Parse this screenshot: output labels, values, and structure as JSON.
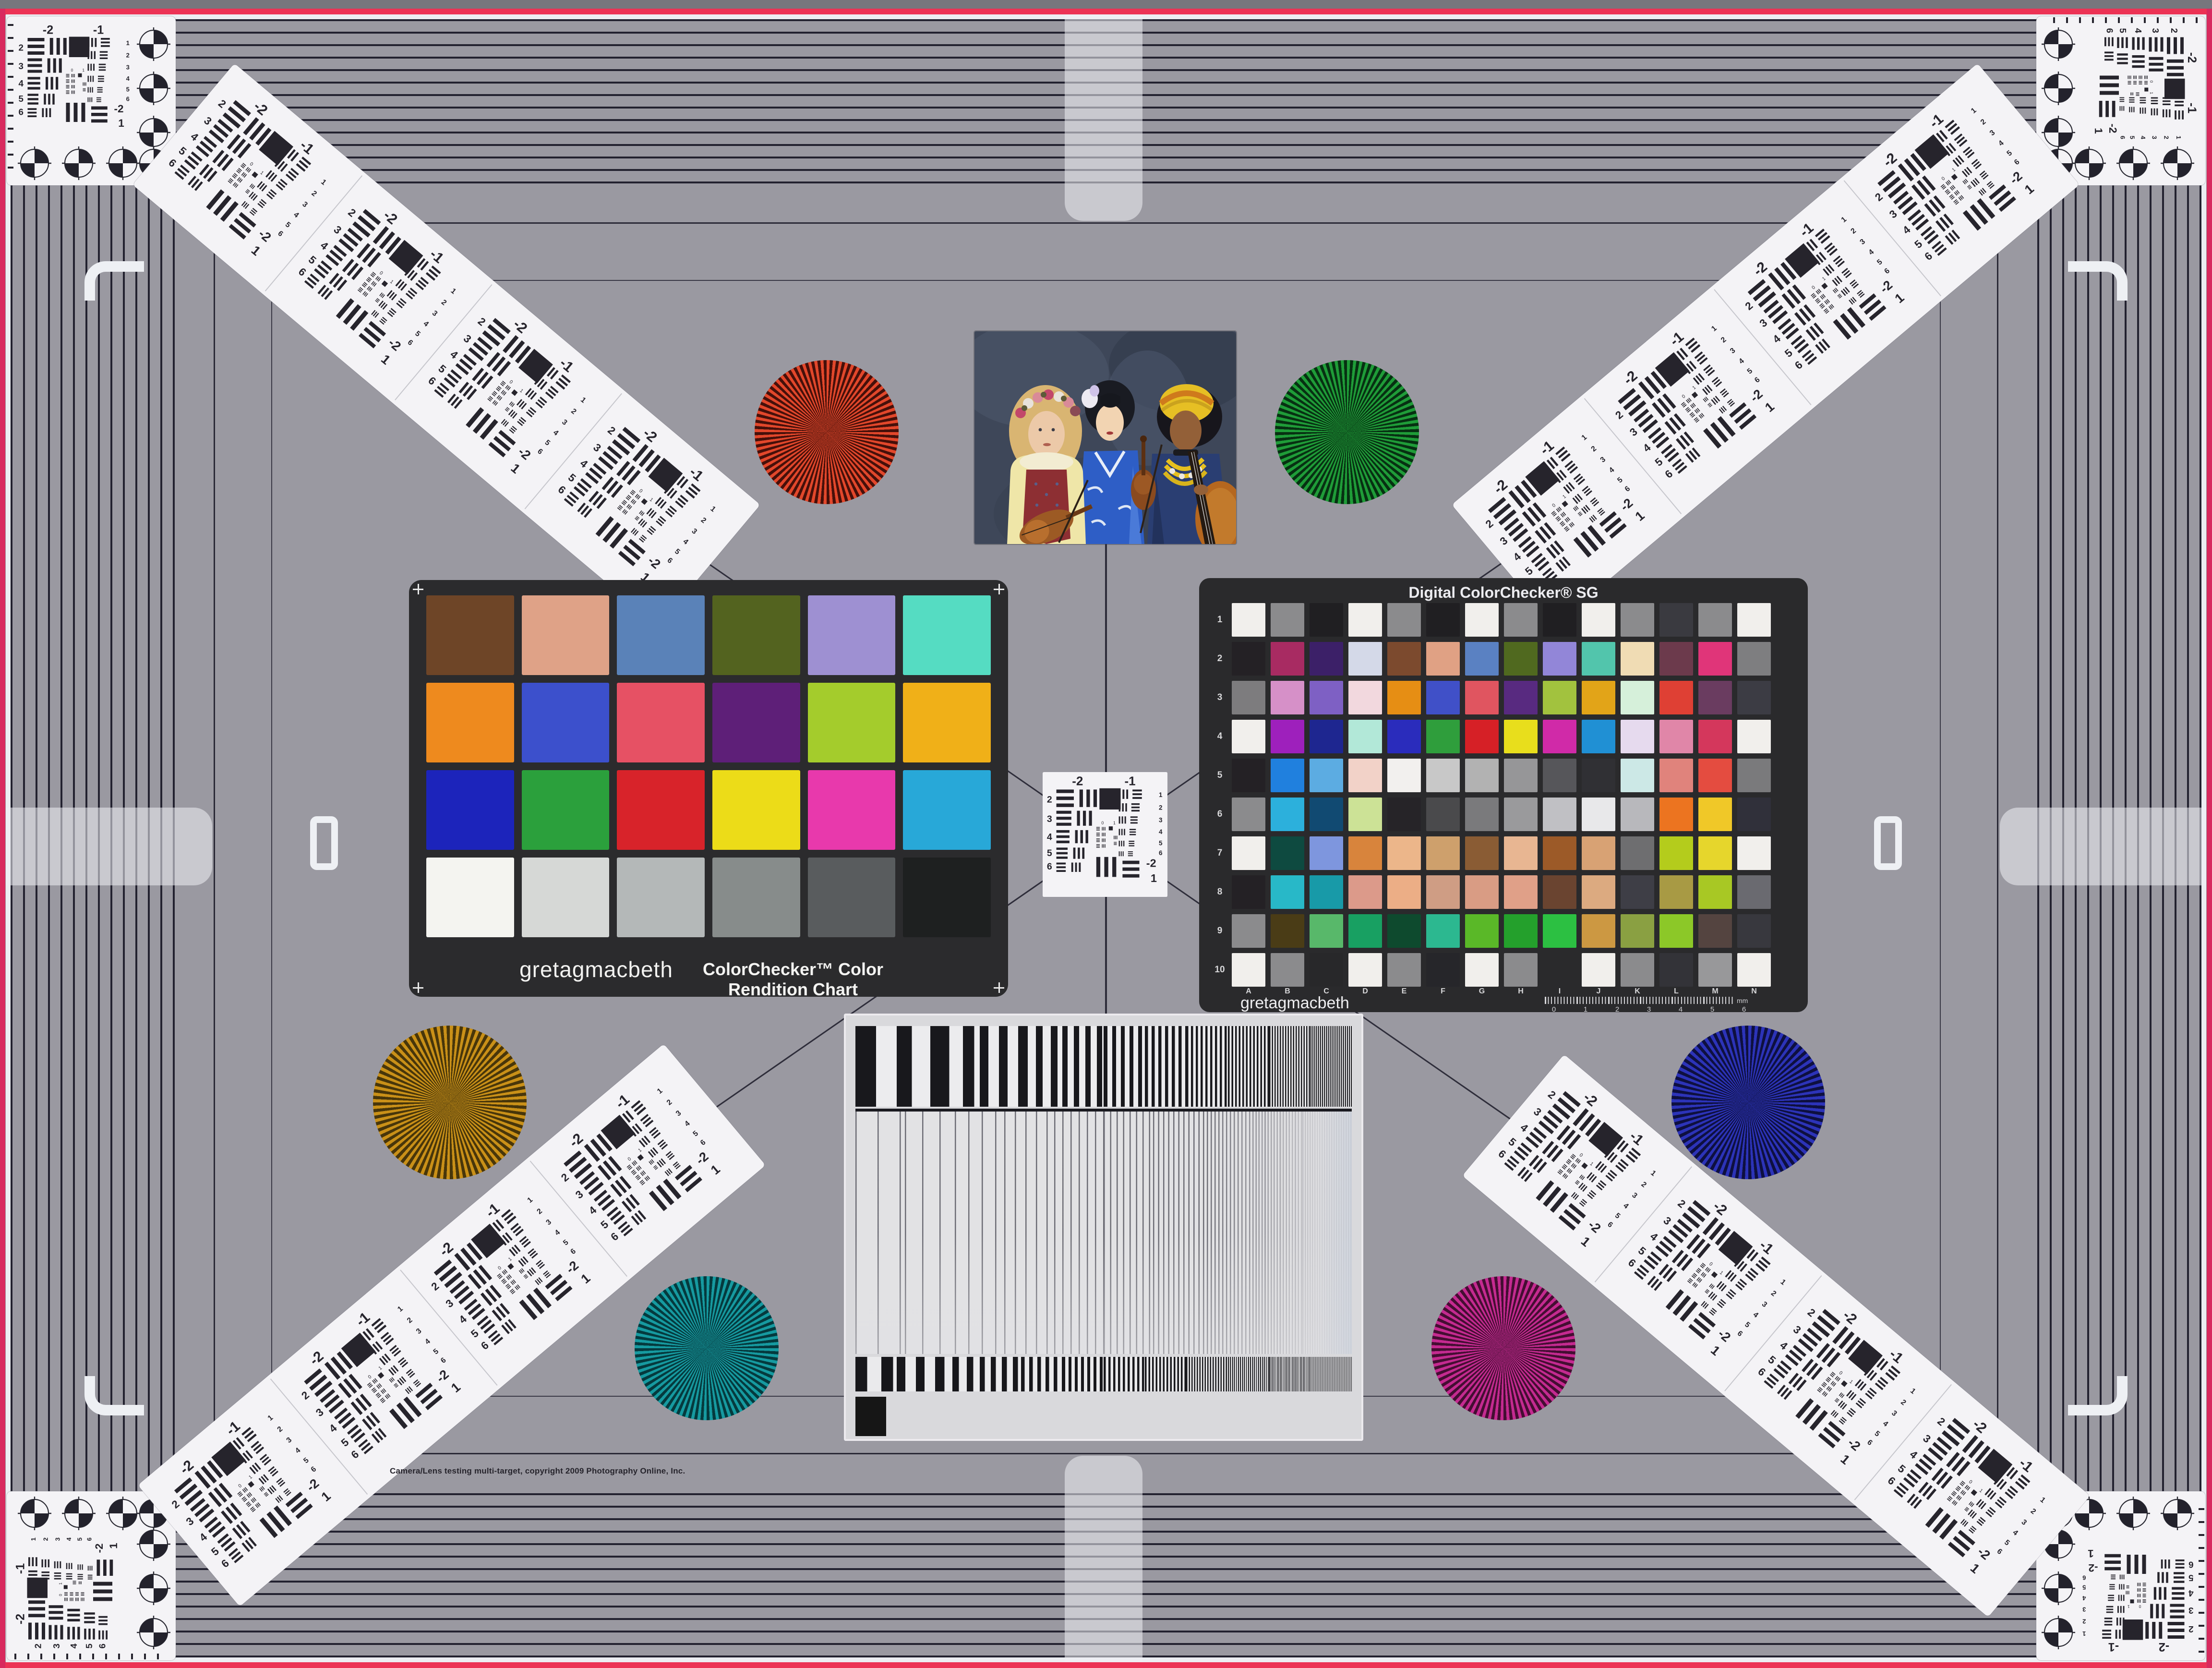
{
  "scene": {
    "copyright": "Camera/Lens testing multi-target, copyright 2009 Photography Online, Inc."
  },
  "colorchecker": {
    "brand": "gretagmacbeth",
    "title": "ColorChecker™ Color Rendition Chart",
    "patches": [
      "#6e4527",
      "#dfa287",
      "#5a82b8",
      "#53631f",
      "#9e90d2",
      "#55dcc2",
      "#ee8a1e",
      "#3c50cc",
      "#e65164",
      "#5e1f78",
      "#a4cc2c",
      "#f0b018",
      "#1c24bb",
      "#2ba03c",
      "#d8232a",
      "#ecdc18",
      "#e839ac",
      "#28a8d8",
      "#f4f4f0",
      "#d6d8d6",
      "#b4b8b8",
      "#878c8b",
      "#595c5e",
      "#1e2020"
    ]
  },
  "sg": {
    "title": "Digital ColorChecker® SG",
    "brand": "gretagmacbeth",
    "row_labels": [
      "1",
      "2",
      "3",
      "4",
      "5",
      "6",
      "7",
      "8",
      "9",
      "10"
    ],
    "col_labels": [
      "A",
      "B",
      "C",
      "D",
      "E",
      "F",
      "G",
      "H",
      "I",
      "J",
      "K",
      "L",
      "M",
      "N"
    ],
    "ruler_numbers": [
      "0",
      "1",
      "2",
      "3",
      "4",
      "5",
      "6"
    ],
    "ruler_unit": "mm",
    "rows": [
      [
        "#f1efec",
        "#8b8b8d",
        "#201f22",
        "#f1efec",
        "#8b8b8d",
        "#201f22",
        "#f1efec",
        "#8b8b8d",
        "#201f22",
        "#f1efec",
        "#8b8b8d",
        "#3a3a40",
        "#8b8b8d",
        "#f1efec"
      ],
      [
        "#242125",
        "#a82b62",
        "#3c2068",
        "#d4d9e8",
        "#7c4a2e",
        "#e0a184",
        "#5a81c2",
        "#50691f",
        "#9286d8",
        "#52c5ac",
        "#f0dcb4",
        "#6c3a4c",
        "#e03579",
        "#7e7e80"
      ],
      [
        "#7d7c7e",
        "#d690c8",
        "#7e60c4",
        "#f2d8de",
        "#e68e14",
        "#4050c8",
        "#e05560",
        "#582a80",
        "#a2c23e",
        "#e2a418",
        "#d6f0da",
        "#df4034",
        "#6a3c60",
        "#3c3c44"
      ],
      [
        "#f1efec",
        "#9e20bc",
        "#1e2690",
        "#b2e8d8",
        "#2a2cbc",
        "#2f9e3c",
        "#d62026",
        "#e8de1c",
        "#d02aa8",
        "#2090d4",
        "#e6daee",
        "#e086a8",
        "#d4375c",
        "#f1efec"
      ],
      [
        "#242125",
        "#2080de",
        "#5cace2",
        "#f2d2c8",
        "#f2f0ee",
        "#c8c8c8",
        "#b2b2b2",
        "#969698",
        "#56565a",
        "#303034",
        "#cce8e6",
        "#e0837c",
        "#e44c40",
        "#7a7a7c"
      ],
      [
        "#8b8b8d",
        "#2cb0dc",
        "#114a72",
        "#cce296",
        "#262428",
        "#4a4a4c",
        "#7a7a7c",
        "#9a9a9c",
        "#c0c0c4",
        "#e8e8ea",
        "#b8b8bc",
        "#ec7420",
        "#f0c828",
        "#30303a"
      ],
      [
        "#f1efec",
        "#0e4a40",
        "#7e96de",
        "#d8843c",
        "#ecb68a",
        "#cea06c",
        "#8a5c34",
        "#e8b692",
        "#9c5a28",
        "#d8a274",
        "#6e6e70",
        "#b4cc1c",
        "#e6d62c",
        "#f1efec"
      ],
      [
        "#242125",
        "#28b8c8",
        "#189aa8",
        "#dc9a8a",
        "#ecae86",
        "#cf9d84",
        "#d99c84",
        "#e0a088",
        "#6a4430",
        "#dcaa80",
        "#3e3e46",
        "#a89a44",
        "#a8c824",
        "#6a6a70"
      ],
      [
        "#8b8b8d",
        "#4a3c16",
        "#58b86a",
        "#18a062",
        "#0e4a2e",
        "#2cb890",
        "#5ab828",
        "#24a02c",
        "#2cc042",
        "#cc9842",
        "#8aa042",
        "#8cc828",
        "#544440",
        "#38383e"
      ],
      [
        "#f1efec",
        "#8b8b8d",
        "#28282a",
        "#f1efec",
        "#8b8b8d",
        "#26262a",
        "#f1efec",
        "#8b8b8d",
        "#2a2a2c",
        "#f1efec",
        "#8b8b8d",
        "#333338",
        "#98989a",
        "#f1efec"
      ]
    ]
  },
  "usaf": {
    "top_left": "-2",
    "top_right": "-1",
    "left_numbers": [
      "2",
      "3",
      "4",
      "5",
      "6"
    ],
    "right_numbers": [
      "1",
      "2",
      "3",
      "4",
      "5",
      "6"
    ],
    "corner_top": "-2",
    "corner_bottom": "1",
    "mini_labels": [
      "0",
      "1"
    ]
  },
  "stars": [
    {
      "name": "red-siemens-star",
      "bright": "#e2472b",
      "dark": "#46100a"
    },
    {
      "name": "green-siemens-star",
      "bright": "#1f9c38",
      "dark": "#073012"
    },
    {
      "name": "gold-siemens-star",
      "bright": "#c99018",
      "dark": "#48360a"
    },
    {
      "name": "blue-siemens-star",
      "bright": "#2c33b8",
      "dark": "#0e1040"
    },
    {
      "name": "teal-siemens-star",
      "bright": "#169aa0",
      "dark": "#053a3e"
    },
    {
      "name": "magenta-siemens-star",
      "bright": "#c42a90",
      "dark": "#440e32"
    }
  ],
  "grayscale": {
    "end_square": "#161616",
    "steps": [
      "#f4f4f4",
      "#ececec",
      "#e2e2e2",
      "#d6d6d6",
      "#cacaca",
      "#bebebe",
      "#b2b2b2",
      "#a8a8a8",
      "#9e9e9e",
      "#949496",
      "#8c8c8e",
      "#848486",
      "#7d7d7f",
      "#767678",
      "#707072",
      "#6a6a6c"
    ]
  },
  "photo": {
    "label": "three-musicians-test-photo"
  },
  "palette": {
    "background": "#9a99a1",
    "stripe_line": "#232230",
    "pink_edge": "#ec3355",
    "card_white": "#f4f3f6",
    "chart_bg": "#2b2b2d"
  }
}
